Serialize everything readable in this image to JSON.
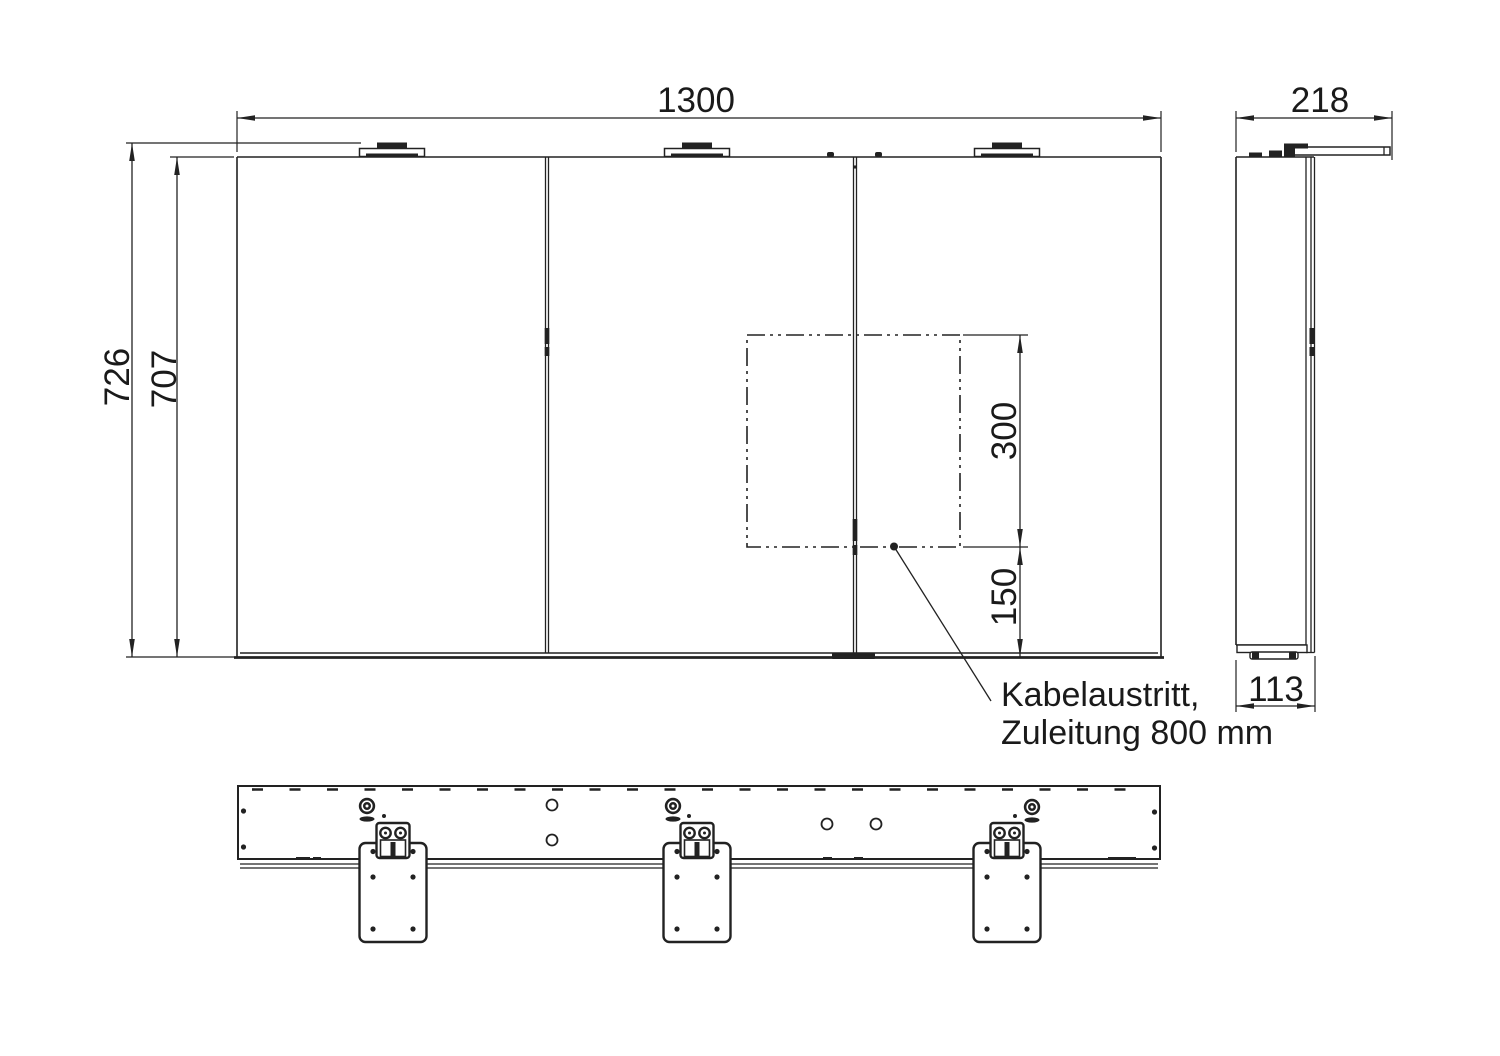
{
  "drawing": {
    "line_color": "#222222",
    "background": "#ffffff",
    "dimensions": {
      "front_width": "1300",
      "overall_height": "726",
      "body_height": "707",
      "cable_zone_height": "300",
      "cable_zone_offset": "150",
      "depth_overall": "218",
      "depth_body": "113"
    },
    "leader": {
      "line1": "Kabelaustritt,",
      "line2": "Zuleitung 800 mm"
    }
  }
}
